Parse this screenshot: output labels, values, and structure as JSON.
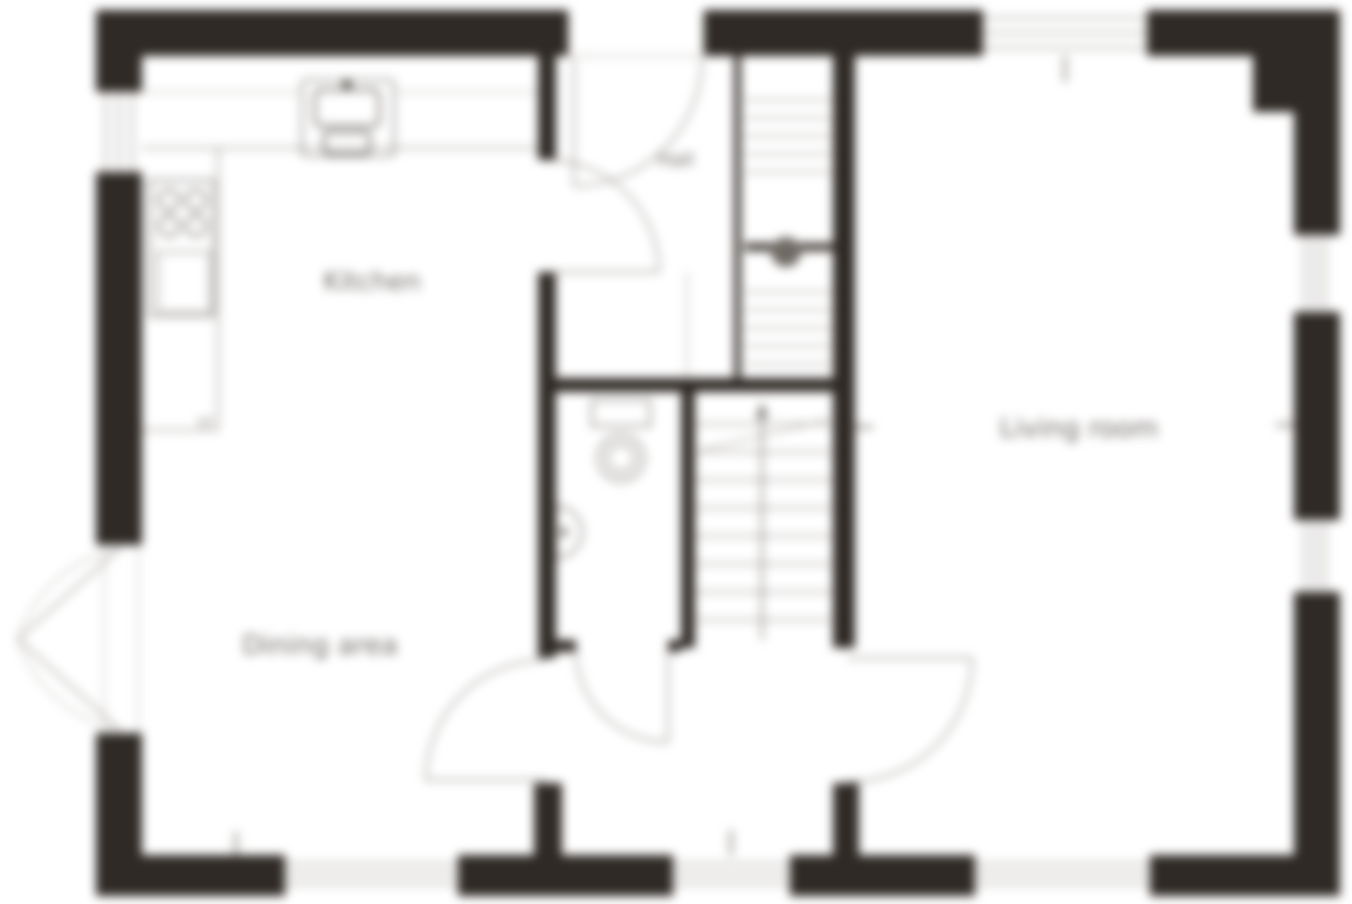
{
  "document": {
    "type": "floor-plan"
  },
  "rooms": {
    "kitchen": {
      "label": "Kitchen"
    },
    "dining_area": {
      "label": "Dining area"
    },
    "living_room": {
      "label": "Living room"
    },
    "hall": {
      "label": "Hall"
    }
  },
  "annotations": {
    "fridge_freezer": {
      "label": "f/f"
    }
  },
  "fixtures": [
    "worktop",
    "sink",
    "hob",
    "oven",
    "store-shelves",
    "hot-water-cylinder",
    "toilet",
    "basin",
    "staircase-up",
    "radiator-marks"
  ],
  "doors": [
    "front-door",
    "kitchen-door",
    "wc-door",
    "dining-door",
    "living-room-door",
    "french-doors"
  ],
  "windows": [
    "kitchen-side-window",
    "living-room-top-window",
    "living-room-right-window-upper",
    "living-room-right-window-lower",
    "dining-window",
    "inner-hall-window",
    "living-room-bottom-window"
  ],
  "colors": {
    "wall": "#2f2a26",
    "thin_line": "#8a8580",
    "fixture_line": "#6b6660",
    "label_text": "#6f6a66",
    "background": "#ffffff"
  }
}
